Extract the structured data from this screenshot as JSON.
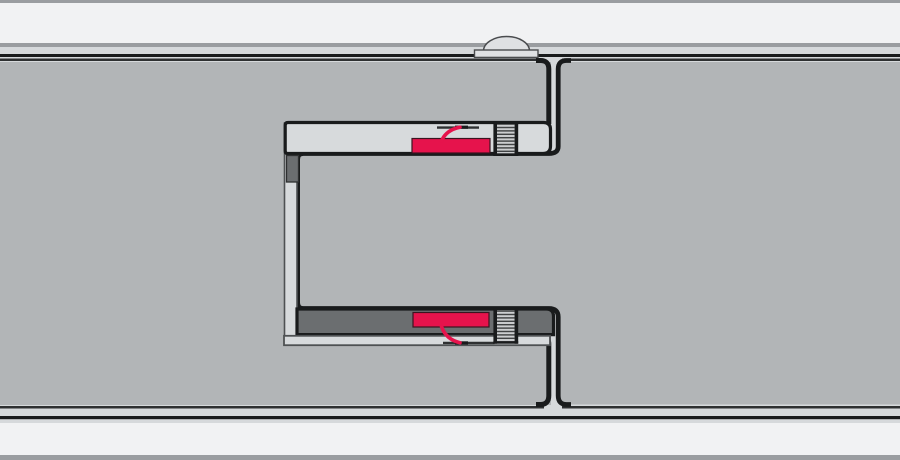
{
  "diagram": {
    "kind": "panel-joint-cross-section",
    "components": [
      "outer-skin-top",
      "outer-skin-bottom",
      "panel-left",
      "panel-right",
      "joint-gap",
      "joint-profile-top-flange",
      "joint-profile-web",
      "joint-profile-bottom-flange",
      "spacer-block-top",
      "spacer-bar-bottom",
      "gasket-top",
      "gasket-bottom",
      "sealant-wire-top",
      "sealant-wire-bottom",
      "screw-top",
      "screw-bottom",
      "rivet-dome",
      "rivet-base-plate"
    ]
  },
  "colors": {
    "bg_outer_strip": "#f1f2f3",
    "bg_border_gray": "#9a9da0",
    "gap_light": "#d6d9db",
    "panel_gray": "#b2b5b7",
    "profile_light": "#d7dadc",
    "dark_bar": "#6b6e70",
    "line_black": "#191b1c",
    "line_soft": "#2e3031",
    "edge_thin": "#4e5153",
    "gasket_red": "#e6134c",
    "redline_dark": "#3a1520",
    "screw_bg": "#ccced0",
    "screw_line": "#3c3e3f",
    "dome_light": "#dfe1e3",
    "dome_edge": "#4a4c4e"
  }
}
